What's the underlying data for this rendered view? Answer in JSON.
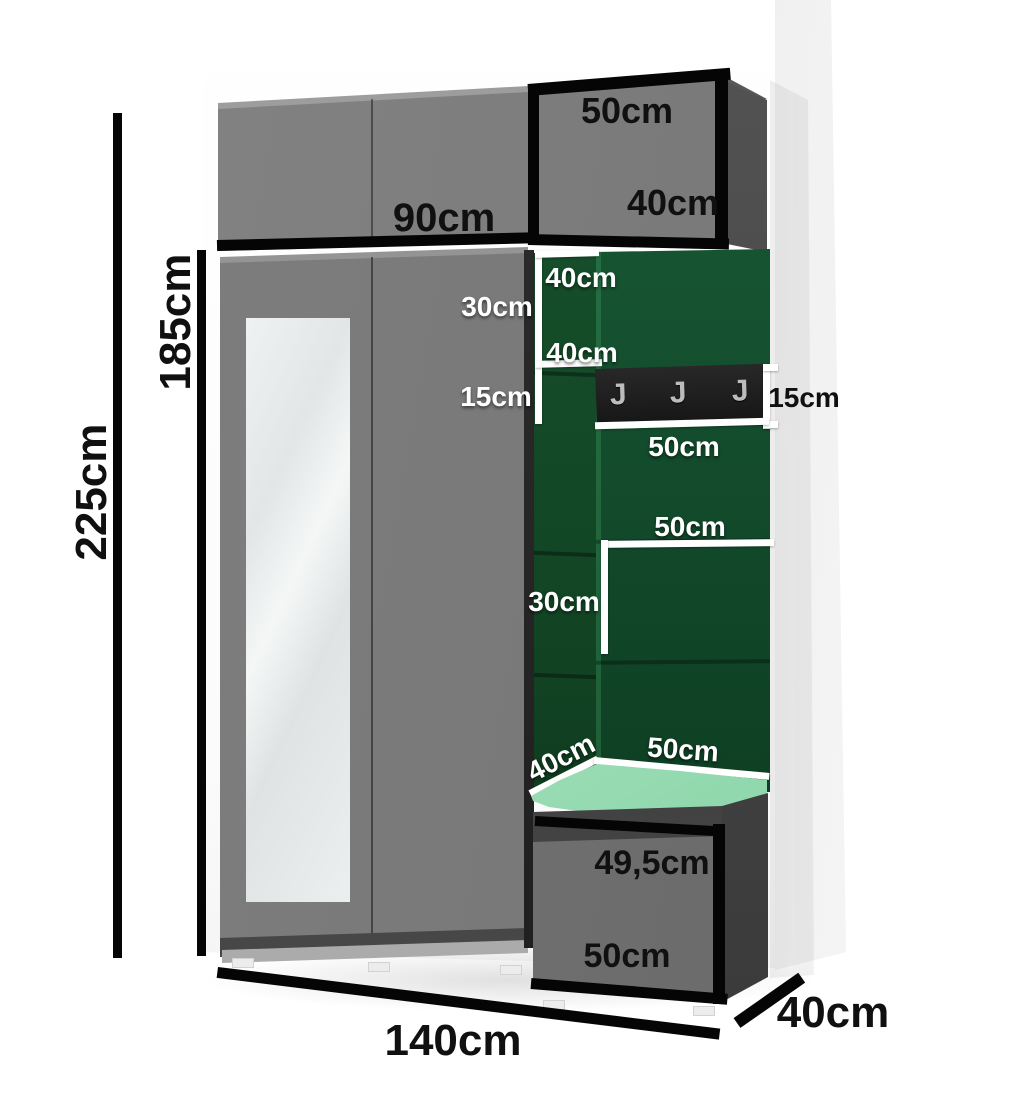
{
  "dimensions": {
    "total_height": "225cm",
    "wardrobe_height": "185cm",
    "upper_cabinet_width": "90cm",
    "upper_right_cabinet_width": "50cm",
    "upper_right_cabinet_depth": "40cm",
    "panel_top_height": "40cm",
    "gap_upper": "30cm",
    "panel_second_height": "40cm",
    "gap_lower": "15cm",
    "hook_panel_height": "15cm",
    "hook_panel_width": "50cm",
    "mid_panel_width": "50cm",
    "mid_panel_height": "30cm",
    "seat_depth": "40cm",
    "seat_width": "50cm",
    "bench_height": "49,5cm",
    "bench_width": "50cm",
    "total_width": "140cm",
    "total_depth": "40cm"
  },
  "icons": {
    "coat_hook_glyph": "J"
  },
  "colors": {
    "panel_green": "#14522c",
    "cushion_mint": "#a9e3c1",
    "cabinet_gray": "#7a7a7a",
    "cabinet_dark_gray": "#4a4a4a",
    "hook_panel_black": "#1d1d1d",
    "dimension_black": "#050505",
    "dimension_white": "#ffffff"
  }
}
